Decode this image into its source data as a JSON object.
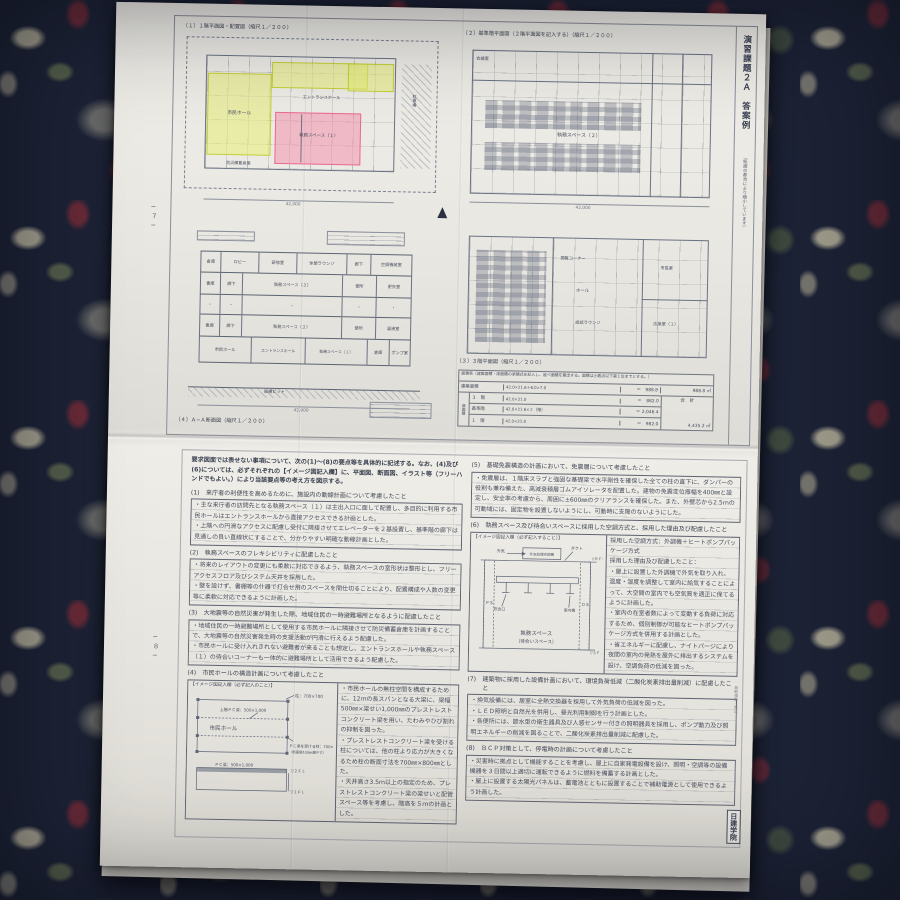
{
  "scene": {
    "carpet_base": "#1d2336",
    "paper": "#eae8e3",
    "ink": "#474d5e",
    "drawing_line": "#6b7284",
    "highlight_yellow": "#e7ee76",
    "highlight_pink": "#f38caa"
  },
  "top_sheet": {
    "page_no": "−７−",
    "side_title": "演習課題２Ａ　答案例",
    "side_note": "（紙面の都合により縮小しています）",
    "p1": {
      "title": "〔１〕１階平面図・配置図（縮尺１／２００）",
      "labels": {
        "hall": "市民ホール",
        "entrance": "エントランスホール",
        "office1": "執務スペース（１）",
        "bousai": "防災備蓄倉庫",
        "parking": "駐車場",
        "dim": "42,000"
      }
    },
    "p2": {
      "title": "〔２〕基準階平面図（２階平面図を記入する）（縮尺１／２００）",
      "labels": {
        "office2": "執務スペース（２）",
        "meeting": "会議室",
        "dim": "42,000"
      }
    },
    "p3": {
      "title": "〔３〕３階平面図（縮尺１／２００）",
      "labels": {
        "reading": "閲覧コーナー",
        "hall": "ホール",
        "lounge": "談話ラウンジ",
        "mayor": "市長室",
        "recept": "応接室（１）"
      }
    },
    "p4": {
      "title": "〔４〕Ａ−Ａ断面図（縮尺１／２００）",
      "rows": {
        "r1": [
          "倉庫",
          "ロビー",
          "研修室",
          "休憩ラウンジ",
          "廊下",
          "空調機械室"
        ],
        "r2": [
          "書庫",
          "廊下",
          "執務スペース（３）",
          "便所",
          "更衣室"
        ],
        "r3": [
          "・",
          "・",
          "・",
          "・",
          "・"
        ],
        "r4": [
          "書庫",
          "廊下",
          "執務スペース（２）",
          "便所",
          "湯沸室"
        ],
        "r5": [
          "市民ホール",
          "エントランスホール",
          "執務スペース（１）",
          "倉庫",
          "ポンプ室"
        ]
      },
      "pit": "設備ピット",
      "dim": "42,000"
    },
    "area_table": {
      "caption": "面積表（建築面積・床面積の求積式を記入し、延べ面積を算出する。面積は小数点以下第１位までとする。）",
      "r1_label": "建築面積",
      "r1_formula": "42.0×21.6＋6.0×7.0",
      "r1_value": "＝　988.8",
      "r1_total": "988.8 ㎡",
      "floor_group": "床面積",
      "r2_label": "３　階",
      "r2_formula": "42.0×21.0",
      "r2_value": "＝　882.0",
      "r3_label": "基準階",
      "r3_formula": "42.0×21.6×２（階）",
      "r3_value": "＝ 2,046.4",
      "r4_label": "１　階",
      "r4_formula": "42.0×21.0",
      "r4_value": "＝　982.0",
      "total_label": "合　計",
      "total_value": "4,435.2 ㎡"
    }
  },
  "bottom_sheet": {
    "page_no": "−８−",
    "intro": "要求図面では表せない事項について、次の(1)〜(8)の要点等を具体的に記述する。なお、(4)及び(6)については、必ずそれぞれの【イメージ図記入欄】に、平面図、断面図、イラスト等（フリーハンドでもよい。）により当該要点等の考え方を図示する。",
    "s1": {
      "num": "(1)",
      "heading": "来庁者の利便性を高めるために、施設内の動線計画について考慮したこと",
      "b1": "・主な来庁者の訪問先となる執務スペース（１）は主出入口に面して配置し、多目的に利用する市民ホールはエントランスホールから直接アクセスできる計画とした。",
      "b2": "・上階への円滑なアクセスに配慮し受付に隣接させてエレベーターを２基設置し、基準階の廊下は見通しの良い直線状にすることで、分かりやすい明確な動線計画とした。"
    },
    "s2": {
      "num": "(2)",
      "heading": "執務スペースのフレキシビリティに配慮したこと",
      "b1": "・将来のレイアウトの変更にも柔軟に対応できるよう、執務スペースの室形状は整形とし、フリーアクセスフロア及びシステム天井を採用した。",
      "b2": "・壁を設けず、書棚等の什器で打合せ用のスペースを間仕切ることにより、配置構成や人数の変更等に柔軟に対応できるように計画した。"
    },
    "s3": {
      "num": "(3)",
      "heading": "大地震等の自然災害が発生した際、地域住民の一時避難場所となるように配慮したこと",
      "b1": "・地域住民の一時避難場所として使用する市民ホールに隣接させて防災備蓄倉庫を計画することで、大地震等の自然災害発生時の支援活動が円滑に行えるよう配慮した。",
      "b2": "・市民ホールに受け入れきれない避難者が来ることも想定し、エントランスホールや執務スペース（１）の待合いコーナーも一体的に避難場所として活用できるよう配慮した。"
    },
    "s4": {
      "num": "(4)",
      "heading": "市民ホールの構造計画について考慮したこと",
      "b1": "・市民ホールの無柱空間を構成するために、12ｍの長スパンとなる大梁に、梁幅500㎜×梁せい1,000㎜のプレストレストコンクリート梁を用い、たわみやひび割れの抑制を図った。",
      "b2": "・プレストレストコンクリート梁を受ける柱については、他の柱より応力が大きくなるため柱の断面寸法を700㎜×800㎜とした。",
      "b3": "・天井高さ3.5ｍ以上の指定のため、プレストレストコンクリート梁の梁せいと配管スペース等を考慮し、階高を５ｍの計画とした。"
    },
    "fig4": {
      "box_label": "【イメージ図記入欄（必ず記入のこと）】",
      "hall": "市民ホール",
      "col": "柱：700×700",
      "pc_upper": "上階ＰＣ梁：500×1,000",
      "pc_col": "ＰＣ梁を受ける柱：700×800",
      "pc_col2": "（断面積100㎜増やす）",
      "pc_beam": "ＰＣ梁：500×1,000",
      "lv2": "▽２ＦＬ",
      "lv1": "▽１ＦＬ"
    },
    "s5": {
      "num": "(5)",
      "heading": "基礎免震構造の計画において、免震層について考慮したこと",
      "b1": "・免震層は、１階床スラブと強固な基礎梁で水平剛性を確保した全ての柱の直下に、ダンパーの役割も兼ね備えた、高減衰積層ゴムアイソレータを配置した。建物の免震変位振幅を400㎜と設定し、安全率の考慮から、周囲に±600㎜のクリアランスを確保した。また、外壁芯から2.5ｍの可動域には、固定物を設置しないようにし、可動時に支障のないようにした。"
    },
    "s6": {
      "num": "(6)",
      "heading": "執務スペース及び待合いスペースに採用した空調方式と、採用した理由及び配慮したこと",
      "b1": "・屋上に設置した外調機で外気を取り入れ、温度・湿度を調整して室内に給気することによって、大空間の室内でも空気質を適正に保てるように計画した。",
      "b2": "・室内の在室者数によって変動する負荷に対応するため、個別制御が可能なヒートポンプパッケージ方式を併用する計画とした。",
      "b3": "・省エネルギーに配慮し、ナイトパージにより夜間の室内の発熱を屋外に排出するシステムを設け、空調負荷の低減を図った。"
    },
    "fig6": {
      "box_label": "【イメージ図記入欄（必ず記入すること）】",
      "method": "採用した空調方式：外調機＋ヒートポンプパッケージ方式",
      "reason": "採用した理由及び配慮したこと：",
      "oa": "外気",
      "oau": "外気処理空調機",
      "duct": "ダクト",
      "ps": "ＰＳ",
      "ds": "ＤＳ",
      "rfl": "▽ＲＦＬ",
      "fl3": "▽３ＦＬ",
      "diff": "吹出口",
      "idu": "室内機",
      "room1": "執務スペース",
      "room2": "（待合いスペース）"
    },
    "s7": {
      "num": "(7)",
      "heading": "建築物に採用した設備計画において、環境負荷低減（二酸化炭素排出量削減）に配慮したこと",
      "b1": "・換気設備には、居室に全熱交換器を採用して外気負荷の低減を図った。",
      "b2": "・ＬＥＤ照明と自然光を併用し、昼光利用制御を行う計画とした。",
      "b3": "・各便所には、節水型の衛生器具及び人感センサー付きの照明器具を採用し、ポンプ動力及び照明エネルギーの削減を図ることで、二酸化炭素排出量削減に配慮した。"
    },
    "s8": {
      "num": "(8)",
      "heading": "ＢＣＰ対策として、停電時の計画について考慮したこと",
      "b1": "・災害時に拠点として機能することを考慮し、屋上に自家発電設備を設け、照明・空調等の設備機器を３日間以上適切に運転できるように燃料を備蓄する計画とした。",
      "b2": "・屋上に設置する太陽光パネルは、蓄電池とともに設置することで補助電源として使用できるよう計画した。"
    },
    "copy_note": "無断複製・禁止",
    "publisher": "日建学院"
  }
}
